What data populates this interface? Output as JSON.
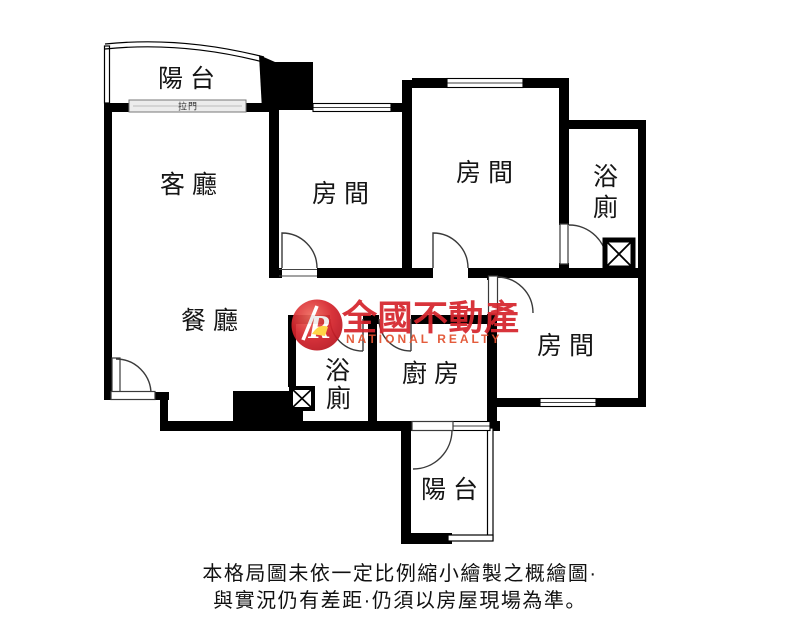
{
  "plan": {
    "rooms": {
      "balcony_top": "陽台",
      "living": "客廳",
      "bedroom_left": "房間",
      "bedroom_top": "房間",
      "bath_top_lines": [
        "浴",
        "廁"
      ],
      "dining": "餐廳",
      "bath_center_lines": [
        "浴",
        "廁"
      ],
      "kitchen": "廚房",
      "bedroom_right": "房間",
      "balcony_bottom": "陽台"
    },
    "fixtures": {
      "sliding_door": "拉門"
    }
  },
  "watermark": {
    "logo_letter": "R",
    "brand": "全國不動產",
    "brand_en": "NATIONAL REALTY",
    "brand_color": "#d6252d",
    "brand_en_color": "#e2502e",
    "accent_color": "#ffd23a"
  },
  "disclaimer": {
    "line1": "本格局圖未依一定比例縮小繪製之概繪圖·",
    "line2": "與實況仍有差距·仍須以房屋現場為準。"
  },
  "colors": {
    "walls": "#000000",
    "background": "#ffffff",
    "sliding_door_fill": "#ececec"
  }
}
